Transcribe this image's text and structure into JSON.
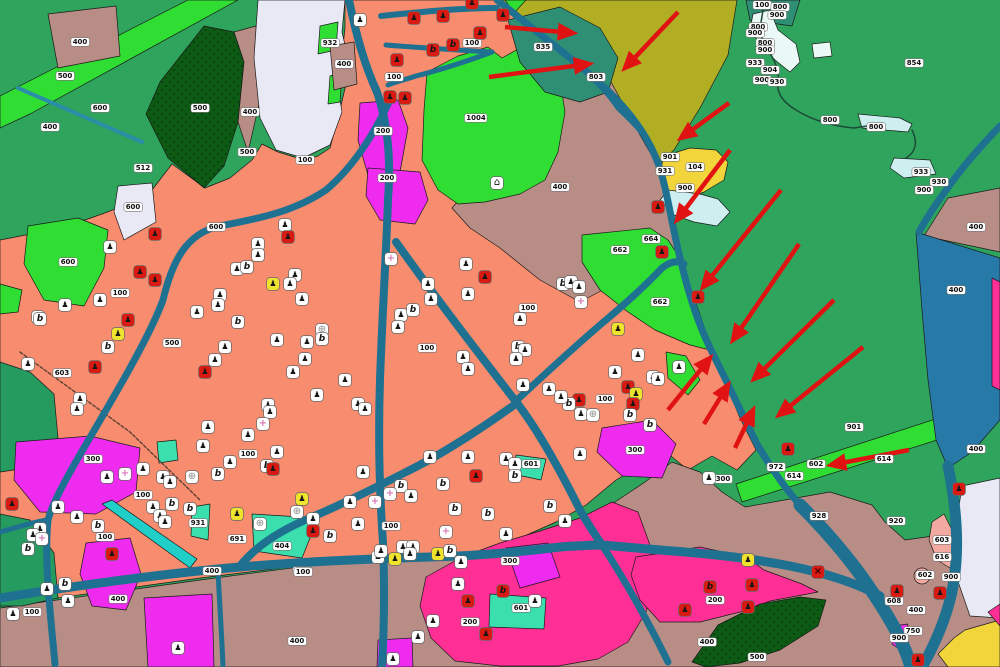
{
  "map": {
    "description": "Land-use / cadastral GIS map with red annotation arrows along a highway",
    "palette": {
      "green_field": "#2FA45C",
      "green_dark_sea": "#269B60",
      "green_teal": "#2E8F74",
      "green_bright": "#2FDD33",
      "green_forest": "#0D5A14",
      "olive": "#B2AE24",
      "yellow": "#F2D43B",
      "mauve": "#B78D85",
      "salmon": "#F78D6E",
      "magenta": "#F02BF0",
      "pink_deep": "#FF2F95",
      "pink_pale": "#F2A9A0",
      "lavender": "#E9E9F6",
      "water_pale": "#CDEFF0",
      "pond_white": "#EAF9F6",
      "turquoise": "#3ADFAD",
      "cyan": "#1FCFC8",
      "road": "#1E7191",
      "channel": "#2A8EA6",
      "blue_band": "#2779A8",
      "stream": "#1C4A38",
      "track": "#5E4034",
      "arrow_red": "#E01312"
    },
    "icon_types": {
      "w": {
        "name": "building-icon",
        "glyph": "♟"
      },
      "b": {
        "name": "utility-icon",
        "glyph": "b"
      },
      "r": {
        "name": "building-icon-red",
        "glyph": "♟"
      },
      "rb": {
        "name": "utility-icon-red",
        "glyph": "b"
      },
      "y": {
        "name": "building-icon-yellow",
        "glyph": "♟"
      },
      "c": {
        "name": "cross-icon",
        "glyph": "+"
      },
      "o": {
        "name": "circle-cross-icon",
        "glyph": "⊕"
      },
      "x": {
        "name": "x-marker-icon",
        "glyph": "×"
      },
      "h": {
        "name": "landmark-icon",
        "glyph": "⌂"
      }
    },
    "parcel_labels": [
      [
        80,
        42,
        "400"
      ],
      [
        65,
        76,
        "500"
      ],
      [
        100,
        108,
        "600"
      ],
      [
        50,
        127,
        "400"
      ],
      [
        200,
        108,
        "500"
      ],
      [
        250,
        112,
        "400"
      ],
      [
        143,
        168,
        "512"
      ],
      [
        133,
        207,
        "600"
      ],
      [
        305,
        160,
        "100"
      ],
      [
        247,
        152,
        "500"
      ],
      [
        330,
        43,
        "932"
      ],
      [
        344,
        64,
        "400"
      ],
      [
        394,
        77,
        "100"
      ],
      [
        472,
        43,
        "100"
      ],
      [
        383,
        131,
        "200"
      ],
      [
        387,
        178,
        "200"
      ],
      [
        476,
        118,
        "1004"
      ],
      [
        543,
        47,
        "835"
      ],
      [
        596,
        77,
        "803"
      ],
      [
        560,
        187,
        "400"
      ],
      [
        216,
        227,
        "600"
      ],
      [
        68,
        262,
        "600"
      ],
      [
        120,
        293,
        "100"
      ],
      [
        172,
        343,
        "500"
      ],
      [
        62,
        373,
        "603"
      ],
      [
        427,
        348,
        "100"
      ],
      [
        528,
        308,
        "100"
      ],
      [
        605,
        399,
        "100"
      ],
      [
        651,
        239,
        "664"
      ],
      [
        620,
        250,
        "662"
      ],
      [
        660,
        302,
        "662"
      ],
      [
        93,
        459,
        "300"
      ],
      [
        143,
        495,
        "100"
      ],
      [
        105,
        537,
        "100"
      ],
      [
        198,
        523,
        "931"
      ],
      [
        237,
        539,
        "691"
      ],
      [
        282,
        546,
        "404"
      ],
      [
        212,
        571,
        "400"
      ],
      [
        248,
        454,
        "100"
      ],
      [
        118,
        599,
        "400"
      ],
      [
        32,
        612,
        "100"
      ],
      [
        297,
        641,
        "400"
      ],
      [
        302,
        571,
        "100"
      ],
      [
        391,
        526,
        "100"
      ],
      [
        510,
        561,
        "300"
      ],
      [
        470,
        622,
        "200"
      ],
      [
        531,
        464,
        "601"
      ],
      [
        521,
        608,
        "601"
      ],
      [
        635,
        450,
        "300"
      ],
      [
        303,
        572,
        "100"
      ],
      [
        715,
        600,
        "200"
      ],
      [
        707,
        642,
        "400"
      ],
      [
        757,
        657,
        "500"
      ],
      [
        884,
        459,
        "614"
      ],
      [
        776,
        467,
        "972"
      ],
      [
        816,
        464,
        "602"
      ],
      [
        794,
        476,
        "614"
      ],
      [
        819,
        516,
        "928"
      ],
      [
        896,
        521,
        "920"
      ],
      [
        942,
        540,
        "603"
      ],
      [
        942,
        557,
        "616"
      ],
      [
        925,
        575,
        "602"
      ],
      [
        951,
        577,
        "900"
      ],
      [
        894,
        601,
        "608"
      ],
      [
        916,
        610,
        "400"
      ],
      [
        913,
        631,
        "750"
      ],
      [
        899,
        638,
        "900"
      ],
      [
        854,
        427,
        "901"
      ],
      [
        914,
        63,
        "854"
      ],
      [
        956,
        290,
        "400"
      ],
      [
        976,
        227,
        "400"
      ],
      [
        723,
        479,
        "300"
      ],
      [
        695,
        167,
        "104"
      ],
      [
        685,
        188,
        "900"
      ],
      [
        670,
        157,
        "901"
      ],
      [
        665,
        171,
        "931"
      ],
      [
        921,
        172,
        "933"
      ],
      [
        939,
        182,
        "930"
      ],
      [
        924,
        190,
        "900"
      ],
      [
        976,
        449,
        "400"
      ],
      [
        762,
        5,
        "100"
      ],
      [
        780,
        7,
        "800"
      ],
      [
        777,
        15,
        "900"
      ],
      [
        758,
        27,
        "800"
      ],
      [
        755,
        33,
        "900"
      ],
      [
        765,
        43,
        "800"
      ],
      [
        765,
        50,
        "900"
      ],
      [
        755,
        63,
        "933"
      ],
      [
        770,
        70,
        "904"
      ],
      [
        762,
        80,
        "900"
      ],
      [
        777,
        82,
        "930"
      ],
      [
        830,
        120,
        "800"
      ],
      [
        876,
        127,
        "800"
      ]
    ],
    "icons": [
      [
        360,
        20,
        "w"
      ],
      [
        414,
        18,
        "r"
      ],
      [
        443,
        16,
        "r"
      ],
      [
        472,
        3,
        "r"
      ],
      [
        480,
        33,
        "r"
      ],
      [
        433,
        50,
        "rb"
      ],
      [
        453,
        45,
        "rb"
      ],
      [
        397,
        60,
        "r"
      ],
      [
        390,
        97,
        "r"
      ],
      [
        405,
        98,
        "r"
      ],
      [
        503,
        15,
        "r"
      ],
      [
        155,
        234,
        "r"
      ],
      [
        110,
        247,
        "w"
      ],
      [
        140,
        272,
        "r"
      ],
      [
        155,
        280,
        "r"
      ],
      [
        128,
        320,
        "r"
      ],
      [
        118,
        334,
        "y"
      ],
      [
        108,
        347,
        "b"
      ],
      [
        95,
        367,
        "r"
      ],
      [
        38,
        317,
        "w"
      ],
      [
        28,
        364,
        "w"
      ],
      [
        80,
        399,
        "w"
      ],
      [
        77,
        409,
        "w"
      ],
      [
        40,
        319,
        "b"
      ],
      [
        65,
        305,
        "w"
      ],
      [
        12,
        504,
        "r"
      ],
      [
        237,
        269,
        "w"
      ],
      [
        247,
        267,
        "b"
      ],
      [
        220,
        295,
        "w"
      ],
      [
        218,
        305,
        "w"
      ],
      [
        197,
        312,
        "w"
      ],
      [
        238,
        322,
        "b"
      ],
      [
        225,
        347,
        "w"
      ],
      [
        215,
        360,
        "w"
      ],
      [
        205,
        372,
        "r"
      ],
      [
        285,
        225,
        "w"
      ],
      [
        288,
        237,
        "r"
      ],
      [
        258,
        244,
        "w"
      ],
      [
        258,
        255,
        "w"
      ],
      [
        295,
        275,
        "w"
      ],
      [
        290,
        284,
        "w"
      ],
      [
        273,
        284,
        "y"
      ],
      [
        302,
        299,
        "w"
      ],
      [
        307,
        342,
        "w"
      ],
      [
        277,
        340,
        "w"
      ],
      [
        305,
        359,
        "w"
      ],
      [
        293,
        372,
        "w"
      ],
      [
        322,
        330,
        "o"
      ],
      [
        322,
        339,
        "b"
      ],
      [
        317,
        395,
        "w"
      ],
      [
        268,
        405,
        "w"
      ],
      [
        270,
        412,
        "w"
      ],
      [
        263,
        424,
        "c"
      ],
      [
        208,
        427,
        "w"
      ],
      [
        248,
        435,
        "w"
      ],
      [
        100,
        300,
        "w"
      ],
      [
        391,
        259,
        "c"
      ],
      [
        428,
        284,
        "w"
      ],
      [
        431,
        299,
        "w"
      ],
      [
        401,
        315,
        "w"
      ],
      [
        398,
        327,
        "w"
      ],
      [
        413,
        310,
        "b"
      ],
      [
        466,
        264,
        "w"
      ],
      [
        485,
        277,
        "r"
      ],
      [
        468,
        294,
        "w"
      ],
      [
        520,
        319,
        "w"
      ],
      [
        518,
        347,
        "b"
      ],
      [
        525,
        350,
        "w"
      ],
      [
        516,
        359,
        "w"
      ],
      [
        463,
        357,
        "w"
      ],
      [
        468,
        369,
        "w"
      ],
      [
        523,
        385,
        "w"
      ],
      [
        549,
        389,
        "w"
      ],
      [
        579,
        400,
        "r"
      ],
      [
        569,
        404,
        "b"
      ],
      [
        581,
        414,
        "w"
      ],
      [
        593,
        415,
        "o"
      ],
      [
        561,
        397,
        "w"
      ],
      [
        563,
        284,
        "b"
      ],
      [
        571,
        282,
        "w"
      ],
      [
        579,
        287,
        "w"
      ],
      [
        581,
        302,
        "c"
      ],
      [
        618,
        329,
        "y"
      ],
      [
        638,
        355,
        "w"
      ],
      [
        615,
        372,
        "w"
      ],
      [
        653,
        377,
        "w"
      ],
      [
        658,
        379,
        "w"
      ],
      [
        628,
        387,
        "r"
      ],
      [
        636,
        394,
        "y"
      ],
      [
        633,
        404,
        "r"
      ],
      [
        630,
        415,
        "b"
      ],
      [
        650,
        425,
        "b"
      ],
      [
        345,
        380,
        "w"
      ],
      [
        358,
        404,
        "w"
      ],
      [
        365,
        409,
        "w"
      ],
      [
        679,
        367,
        "w"
      ],
      [
        497,
        183,
        "h"
      ],
      [
        58,
        507,
        "w"
      ],
      [
        40,
        529,
        "w"
      ],
      [
        33,
        535,
        "w"
      ],
      [
        42,
        539,
        "c"
      ],
      [
        28,
        549,
        "b"
      ],
      [
        77,
        517,
        "w"
      ],
      [
        98,
        526,
        "b"
      ],
      [
        47,
        589,
        "w"
      ],
      [
        65,
        584,
        "b"
      ],
      [
        68,
        601,
        "w"
      ],
      [
        13,
        614,
        "w"
      ],
      [
        107,
        477,
        "w"
      ],
      [
        125,
        474,
        "c"
      ],
      [
        143,
        469,
        "w"
      ],
      [
        163,
        477,
        "w"
      ],
      [
        170,
        482,
        "w"
      ],
      [
        192,
        477,
        "o"
      ],
      [
        153,
        507,
        "w"
      ],
      [
        160,
        516,
        "w"
      ],
      [
        165,
        522,
        "w"
      ],
      [
        172,
        504,
        "b"
      ],
      [
        190,
        509,
        "b"
      ],
      [
        203,
        446,
        "w"
      ],
      [
        218,
        474,
        "b"
      ],
      [
        237,
        514,
        "y"
      ],
      [
        260,
        524,
        "o"
      ],
      [
        230,
        462,
        "w"
      ],
      [
        277,
        452,
        "w"
      ],
      [
        267,
        466,
        "b"
      ],
      [
        273,
        469,
        "r"
      ],
      [
        302,
        499,
        "y"
      ],
      [
        297,
        512,
        "o"
      ],
      [
        313,
        519,
        "w"
      ],
      [
        313,
        531,
        "r"
      ],
      [
        330,
        536,
        "b"
      ],
      [
        112,
        554,
        "r"
      ],
      [
        178,
        648,
        "w"
      ],
      [
        363,
        472,
        "w"
      ],
      [
        350,
        502,
        "w"
      ],
      [
        401,
        486,
        "b"
      ],
      [
        411,
        496,
        "w"
      ],
      [
        390,
        494,
        "c"
      ],
      [
        375,
        502,
        "c"
      ],
      [
        358,
        524,
        "w"
      ],
      [
        430,
        457,
        "w"
      ],
      [
        476,
        476,
        "r"
      ],
      [
        443,
        484,
        "b"
      ],
      [
        468,
        457,
        "w"
      ],
      [
        506,
        459,
        "w"
      ],
      [
        515,
        464,
        "w"
      ],
      [
        515,
        476,
        "b"
      ],
      [
        455,
        509,
        "b"
      ],
      [
        488,
        514,
        "b"
      ],
      [
        550,
        506,
        "b"
      ],
      [
        565,
        521,
        "w"
      ],
      [
        506,
        534,
        "w"
      ],
      [
        446,
        532,
        "c"
      ],
      [
        438,
        554,
        "y"
      ],
      [
        450,
        551,
        "b"
      ],
      [
        461,
        562,
        "w"
      ],
      [
        458,
        584,
        "w"
      ],
      [
        433,
        621,
        "w"
      ],
      [
        468,
        601,
        "r"
      ],
      [
        486,
        634,
        "r"
      ],
      [
        503,
        591,
        "rb"
      ],
      [
        535,
        601,
        "w"
      ],
      [
        580,
        454,
        "w"
      ],
      [
        393,
        659,
        "w"
      ],
      [
        418,
        637,
        "w"
      ],
      [
        403,
        547,
        "w"
      ],
      [
        413,
        547,
        "w"
      ],
      [
        410,
        554,
        "w"
      ],
      [
        395,
        559,
        "y"
      ],
      [
        378,
        557,
        "w"
      ],
      [
        381,
        551,
        "w"
      ],
      [
        658,
        207,
        "r"
      ],
      [
        662,
        252,
        "r"
      ],
      [
        698,
        297,
        "r"
      ],
      [
        788,
        449,
        "r"
      ],
      [
        959,
        489,
        "r"
      ],
      [
        918,
        660,
        "r"
      ],
      [
        748,
        560,
        "y"
      ],
      [
        818,
        572,
        "x"
      ],
      [
        710,
        587,
        "rb"
      ],
      [
        752,
        585,
        "r"
      ],
      [
        685,
        610,
        "r"
      ],
      [
        748,
        607,
        "r"
      ],
      [
        897,
        591,
        "r"
      ],
      [
        940,
        593,
        "r"
      ],
      [
        709,
        478,
        "w"
      ]
    ],
    "arrows": [
      [
        505,
        27,
        573,
        33
      ],
      [
        489,
        77,
        589,
        64
      ],
      [
        678,
        12,
        625,
        68
      ],
      [
        729,
        103,
        681,
        138
      ],
      [
        730,
        150,
        677,
        220
      ],
      [
        781,
        190,
        703,
        287
      ],
      [
        799,
        244,
        733,
        340
      ],
      [
        834,
        300,
        754,
        379
      ],
      [
        863,
        347,
        779,
        415
      ],
      [
        668,
        410,
        710,
        358
      ],
      [
        704,
        424,
        728,
        385
      ],
      [
        735,
        448,
        753,
        410
      ],
      [
        909,
        450,
        831,
        465
      ]
    ]
  }
}
